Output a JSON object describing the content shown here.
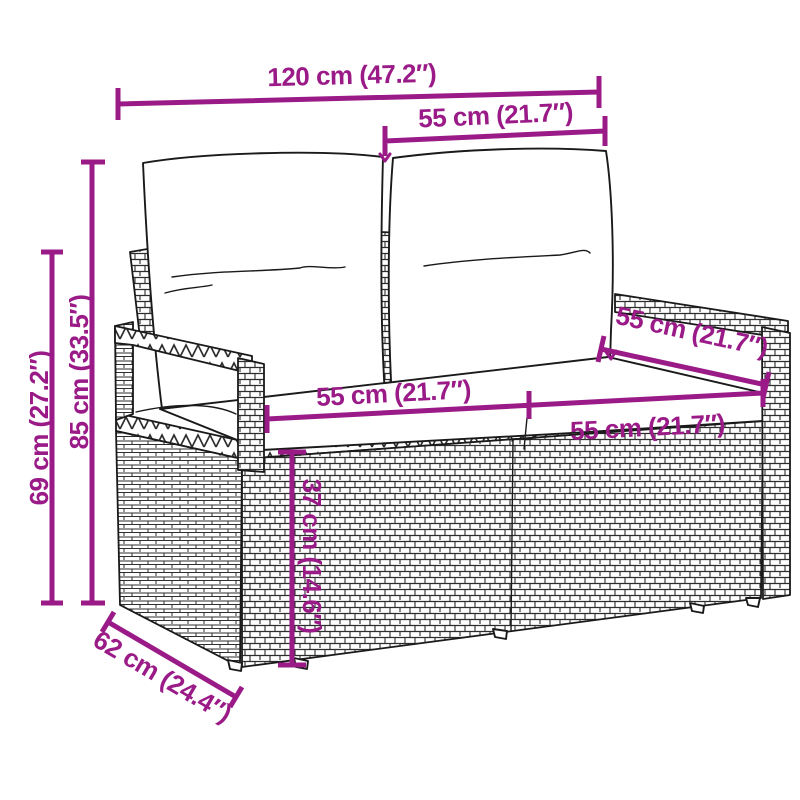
{
  "diagram": {
    "type": "product-dimension-diagram",
    "subject": "rattan 2-seater garden sofa with back and seat cushions"
  },
  "dimensions": {
    "total_width": "120 cm (47.2″)",
    "backrest_section_width": "55 cm (21.7″)",
    "total_height": "85 cm (33.5″)",
    "armrest_height": "69 cm (27.2″)",
    "seat_width_left": "55 cm (21.7″)",
    "seat_width_right": "55 cm (21.7″)",
    "seat_depth": "55 cm (21.7″)",
    "seat_height": "37 cm (14.6″)",
    "total_depth": "62 cm (24.4″)"
  },
  "colors": {
    "dimension_annotation": "#9A1B87",
    "line_art": "#1a1a1a",
    "background": "#ffffff"
  }
}
